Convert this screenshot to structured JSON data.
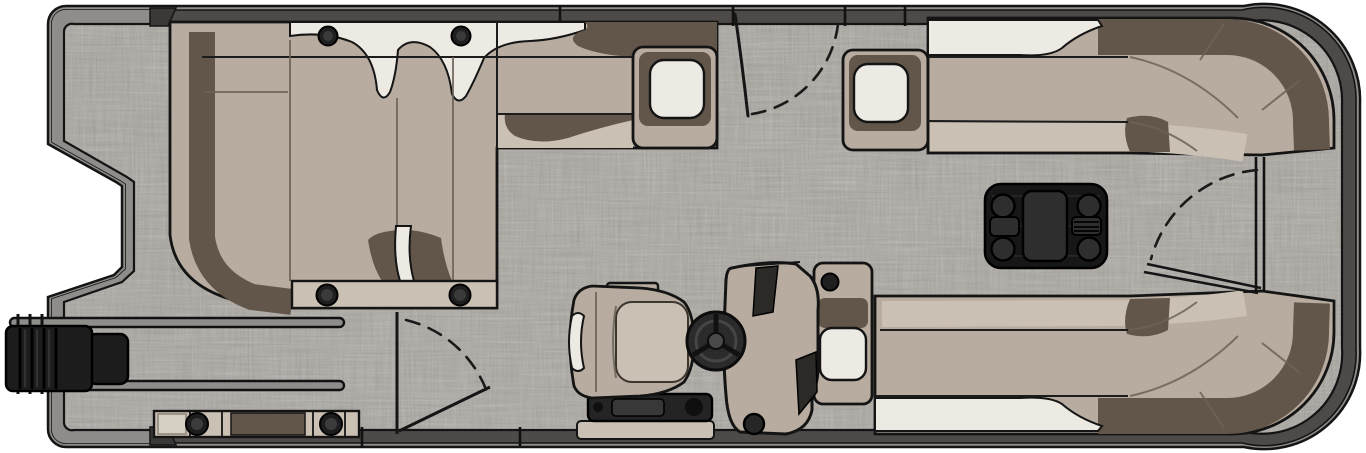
{
  "canvas": {
    "width": 1366,
    "height": 453,
    "background": "#ffffff"
  },
  "diagram": {
    "type": "pontoon-boat-floorplan-top-view",
    "parts": [
      "hull",
      "stern-swim-notch",
      "outboard-motor",
      "motor-mount-rails",
      "deck-floor-woven-vinyl",
      "fence-rail",
      "aft-l-lounge",
      "lounge-pillow",
      "lounge-front-bench",
      "port-side-gate",
      "starboard-side-gate",
      "bow-gate",
      "armrest-box-port",
      "armrest-box-starboard",
      "bow-lounge-top",
      "bow-lounge-bottom",
      "bow-lounge-armrest-console",
      "cocktail-table",
      "helm-console",
      "steering-wheel",
      "captains-chair",
      "helm-base-tray",
      "stern-step-panel",
      "speakers"
    ],
    "counts": {
      "table_cup_holders": 4,
      "lounge_top_rail_cup_holders": 2,
      "lounge_bench_cup_holders": 2,
      "stern_step_speakers": 2,
      "gates": 3,
      "white_armrest_pads": 3
    }
  },
  "colors": {
    "page_bg": "#ffffff",
    "floor_base": "#a7a29b",
    "hull_band": "#8f8d8a",
    "fence_band": "#4d4a48",
    "outline": "#141414",
    "seat_tan": "#b7ac9f",
    "seat_light": "#cac0b3",
    "cushion_white": "#edeae3",
    "shadow_brown": "#62564a",
    "seam": "#6b6358",
    "table_black": "#171717",
    "table_item": "#2e2e2e",
    "motor_black": "#1c1c1c",
    "dark_accent": "#2c2a27",
    "tray_dark": "#242424",
    "wheel_dark": "#2b2b2b"
  }
}
